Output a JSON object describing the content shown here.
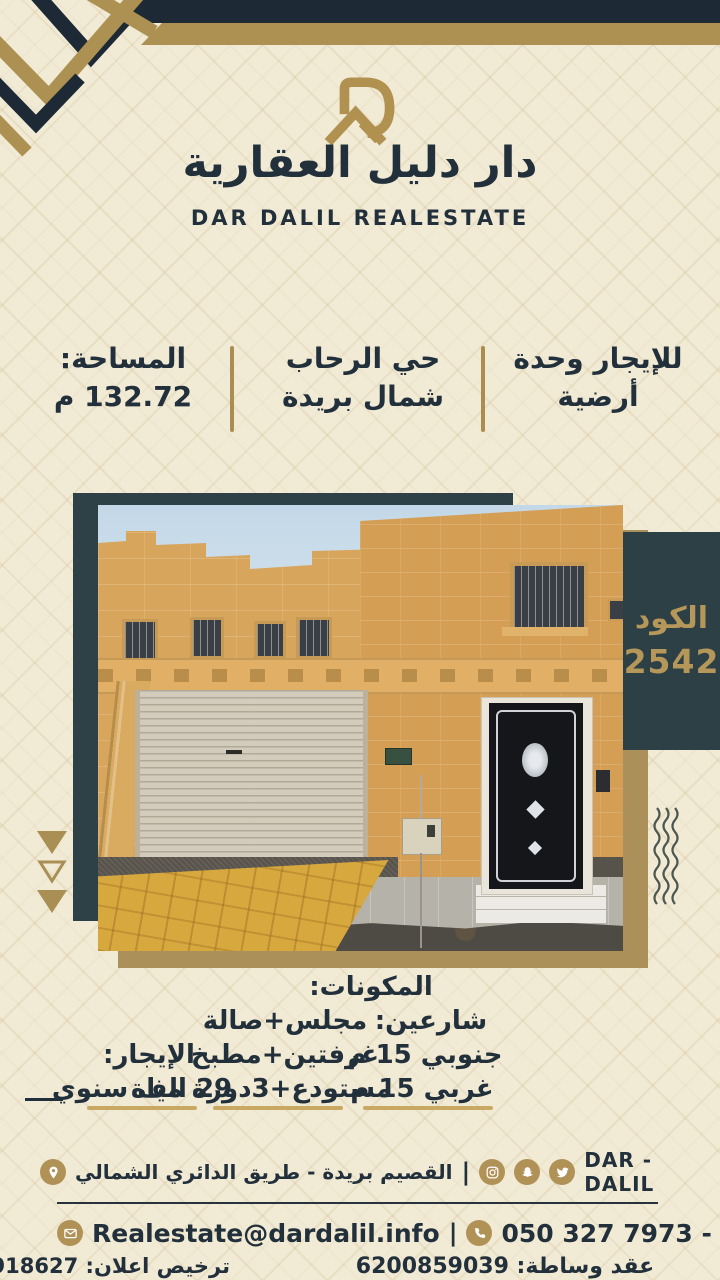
{
  "brand": {
    "logo_mark": "dar-dalil-monogram",
    "title_ar": "دار دليل العقارية",
    "title_en": "DAR DALIL REALESTATE"
  },
  "summary": {
    "offer_line1": "للإيجار وحدة",
    "offer_line2": "أرضية",
    "district_line1": "حي الرحاب",
    "district_line2": "شمال بريدة",
    "area_label": "المساحة:",
    "area_value": "132.72 م"
  },
  "code_badge": {
    "label": "الكود",
    "value": "2542"
  },
  "details": {
    "components": {
      "title": "المكونات:",
      "line1": "مجلس+صالة",
      "line2": "غرفتين+مطبخ",
      "line3": "مستودع+3دورة مياة"
    },
    "streets": {
      "title": "شارعين:",
      "line1": "جنوبي 15 م",
      "line2": "غربي 15 م"
    },
    "rent": {
      "title": "الإيجار:",
      "line1": "29 الف سنوي"
    }
  },
  "footer": {
    "brand_name": "DAR - DALIL",
    "address": "القصيم بريدة - طريق الدائري الشمالي",
    "separator": "|",
    "email": "Realestate@dardalil.info",
    "phones": "050 327 7973 - 055 517 1405",
    "ad_license": "ترخيص اعلان: 7200918627",
    "brokerage_contract": "عقد وساطة: 6200859039",
    "social_icons": [
      "twitter",
      "snapchat",
      "instagram"
    ],
    "contact_icons": [
      "location-pin",
      "email",
      "phone"
    ]
  },
  "colors": {
    "navy": "#1d2a35",
    "teal": "#2e4146",
    "gold": "#ab8d52",
    "cream": "#f1ead5",
    "text_navy": "#22303c",
    "underline_gold": "#c9a863",
    "badge_text_gold": "#b5975a"
  }
}
